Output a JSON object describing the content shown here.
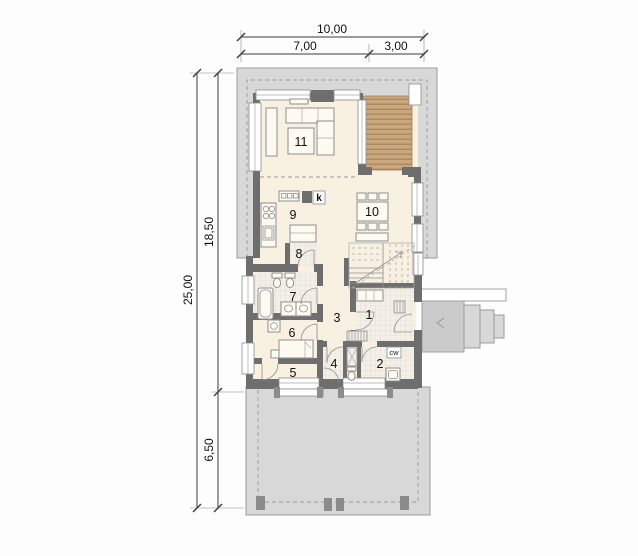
{
  "plan": {
    "type": "single-storey house floor plan",
    "dimensions": {
      "top": {
        "total": "10,00",
        "left": "7,00",
        "right": "3,00"
      },
      "side": {
        "total": "25,00",
        "upper": "18,50",
        "lower": "6,50"
      }
    },
    "rooms": {
      "r1": "1",
      "r2": "2",
      "r3": "3",
      "r4": "4",
      "r5": "5",
      "r6": "6",
      "r7": "7",
      "r8": "8",
      "r9": "9",
      "r10": "10",
      "r11": "11"
    },
    "annotations": {
      "fireplace": "k",
      "hot_water": "cw"
    },
    "colors": {
      "wall": "#6e6e6e",
      "terrace_gray": "#d8d8d8",
      "floor_cream": "#f8f0e1",
      "deck_wood": "#c9a87e",
      "dimension_line": "#3c3c3c"
    }
  }
}
